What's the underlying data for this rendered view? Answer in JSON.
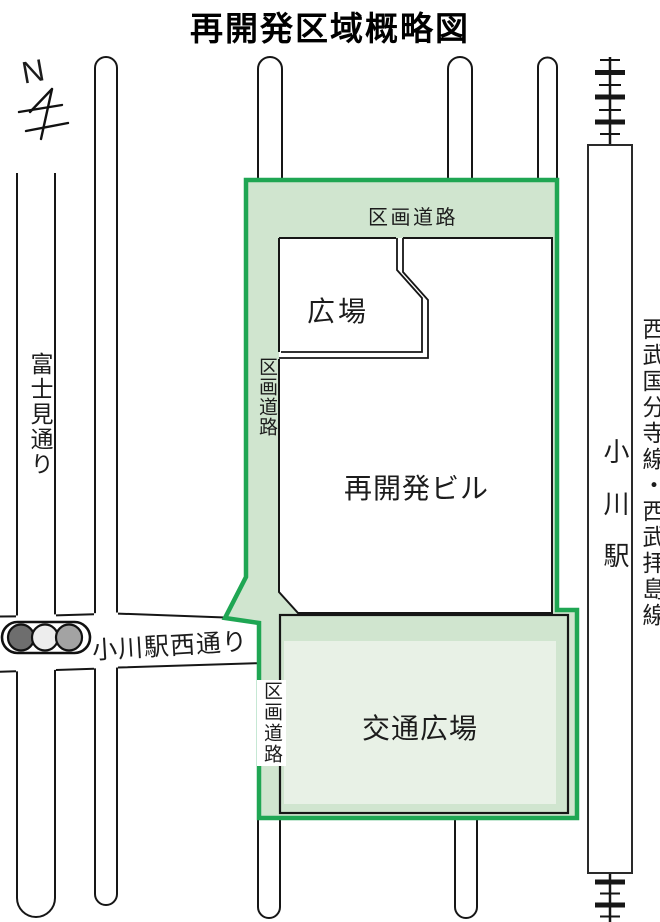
{
  "title": "再開発区域概略図",
  "compass": {
    "north_label": "N"
  },
  "roads": {
    "fujimi_street": "富士見通り",
    "ogawa_station_west_street": "小川駅西通り",
    "district_road_top": "区画道路",
    "district_road_left": "区画道路",
    "district_road_bottom": "区画道路"
  },
  "areas": {
    "plaza": "広場",
    "redevelopment_building": "再開発ビル",
    "transport_plaza": "交通広場"
  },
  "railway": {
    "line_name": "西武国分寺線・西武拝島線",
    "station_name": "小川駅"
  },
  "legend_colors": {
    "district_border_green": "#1fa653",
    "district_fill_green": "#d0e5cf",
    "transport_plaza_inner_fill": "#e8f1e6",
    "signal_lamp_left": "#6e6e6e",
    "signal_lamp_middle": "#ededed",
    "signal_lamp_right": "#a3a3a3"
  }
}
